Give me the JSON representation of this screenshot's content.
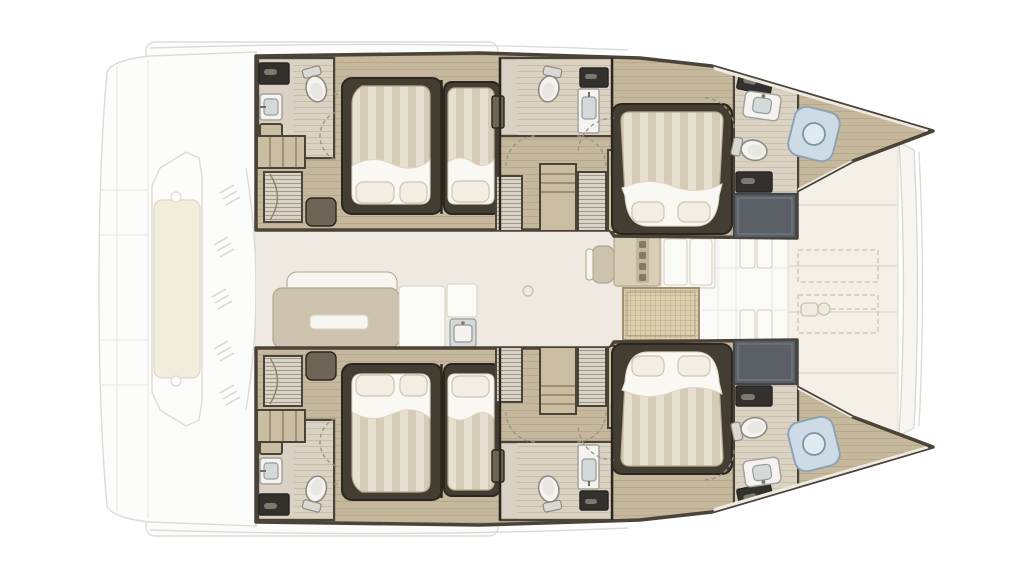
{
  "plan": {
    "kind": "catamaran-yacht-deck-plan",
    "orientation": "bow-right-stern-left",
    "hulls_mirrored": true
  },
  "counts": {
    "double_beds": 4,
    "single_beds": 2,
    "toilets": 6,
    "sinks": 6,
    "shower_rooms": 2,
    "bow_shower_pans": 2,
    "companionway_stairs": 2,
    "wardrobe_units": 6,
    "sunpad_outlines": 2
  },
  "areas": {
    "aft_deck": [
      "swim-platform",
      "transom-steps",
      "central-lounge",
      "vent-grilles"
    ],
    "hull": [
      "aft-head",
      "aft-double-cabin",
      "aft-single-cabin",
      "mid-head",
      "wardrobes",
      "forward-double-cabin",
      "forward-head",
      "shower-room",
      "bow-shower"
    ],
    "salon": [
      "sofa",
      "coffee-table",
      "galley-units",
      "galley-sink",
      "chair",
      "counter",
      "cabinets",
      "woven-mat"
    ],
    "foredeck": [
      "cushion-panels",
      "sunpad-dashed-outlines",
      "anchor-windlass",
      "forward-crossbeam"
    ]
  },
  "colors": {
    "ghostFill": "#fcfcfb",
    "ghostLine": "#dbdbd8",
    "seam": "#e9e9e6",
    "loungePad": "#f2ecdc",
    "loungePadStroke": "#ded7c3",
    "wall": "#4a4337",
    "wallDark": "#2b2620",
    "wood": "#c6b89c",
    "plank": "#a8977a",
    "deckLight": "#dad2c2",
    "plankLight": "#c2b8a3",
    "bathFloor": "#d8d1c4",
    "louverBase": "#d9d3c7",
    "louverLine": "#8f8674",
    "shelf": "#cbbda1",
    "unitLine": "#8e8061",
    "hatch": "#33312e",
    "hatchHandle": "#7d796f",
    "fixtureWhite": "#f4f3f0",
    "fixtureStroke": "#a5a29a",
    "basin": "#d4d9d9",
    "basinStroke": "#969c9a",
    "faucet": "#6f6c64",
    "toiletStroke": "#8e8b83",
    "toiletInner": "#e9e7e2",
    "tank": "#d9d8d3",
    "surround": "#443d32",
    "mattressStroke": "#b6ab93",
    "stripeA": "#e7e0d0",
    "stripeB": "#d5cbb6",
    "sheet": "#faf8f3",
    "sheetStroke": "#ddd6c6",
    "pillow": "#f2eee3",
    "pillowStroke": "#cec5b1",
    "doorDash": "#9a9183",
    "matDark": "#6f6557",
    "showerFloor": "#5b5f66",
    "showerStroke": "#43464c",
    "showerLine": "#73777f",
    "panFill": "#cddbe6",
    "panStroke": "#8ea3b2",
    "panInner": "#e0eaf1",
    "panStroke2": "#7e93a3",
    "edgeWhite": "#eeeae1",
    "salonFloor": "#eeeae1",
    "whiteZone": "#fafaf7",
    "sofa": "#cdc2ae",
    "sofaStroke": "#b1a48c",
    "tableWhite": "#f7f5ef",
    "tableStroke": "#d9d2c0",
    "counter": "#d8cdb7",
    "counterStroke": "#b3a68c",
    "handleCol": "#c3b69c",
    "handleDark": "#857b64",
    "cabinet": "#f9f7f2",
    "cabinetStroke": "#d6d1c5",
    "matFill": "#dccfb0",
    "matLine": "#b09d78",
    "matBorder": "#a28f6d",
    "foredeck": "#f4f0e7",
    "foredeckEdge": "#e3ded2",
    "foredeckLine": "#dfdacd",
    "dash": "#c8c2b3",
    "windlass": "#efebdf",
    "beamFill": "#f6f5f2",
    "beamStroke": "#d8d7d2"
  }
}
